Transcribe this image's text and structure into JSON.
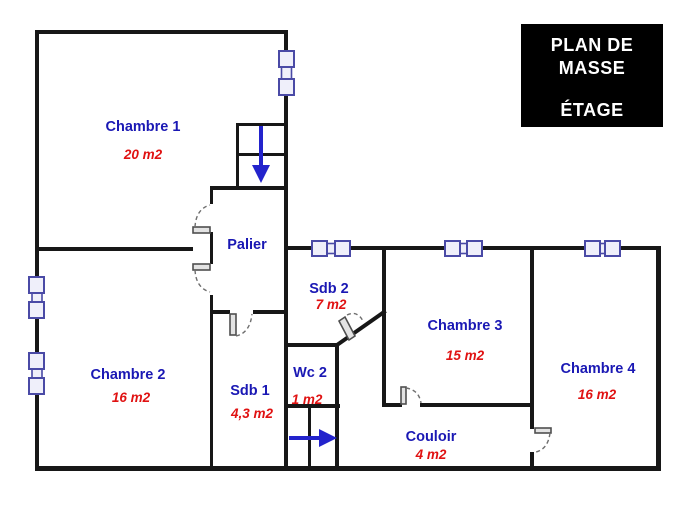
{
  "title_box": {
    "line1": "PLAN DE",
    "line2": "MASSE",
    "line3": "ÉTAGE"
  },
  "rooms": {
    "chambre1": {
      "name": "Chambre 1",
      "area": "20 m2"
    },
    "chambre2": {
      "name": "Chambre 2",
      "area": "16 m2"
    },
    "chambre3": {
      "name": "Chambre 3",
      "area": "15 m2"
    },
    "chambre4": {
      "name": "Chambre 4",
      "area": "16 m2"
    },
    "palier": {
      "name": "Palier"
    },
    "sdb1": {
      "name": "Sdb 1",
      "area": "4,3 m2"
    },
    "sdb2": {
      "name": "Sdb 2",
      "area": "7 m2"
    },
    "wc2": {
      "name": "Wc 2",
      "area": "1 m2"
    },
    "couloir": {
      "name": "Couloir",
      "area": "4 m2"
    }
  },
  "colors": {
    "wall": "#171717",
    "room_name": "#1a18b4",
    "room_area": "#e01212",
    "window_outline": "#4a4aa6",
    "arrow": "#2323cc",
    "title_bg": "#000000",
    "title_fg": "#ffffff"
  }
}
